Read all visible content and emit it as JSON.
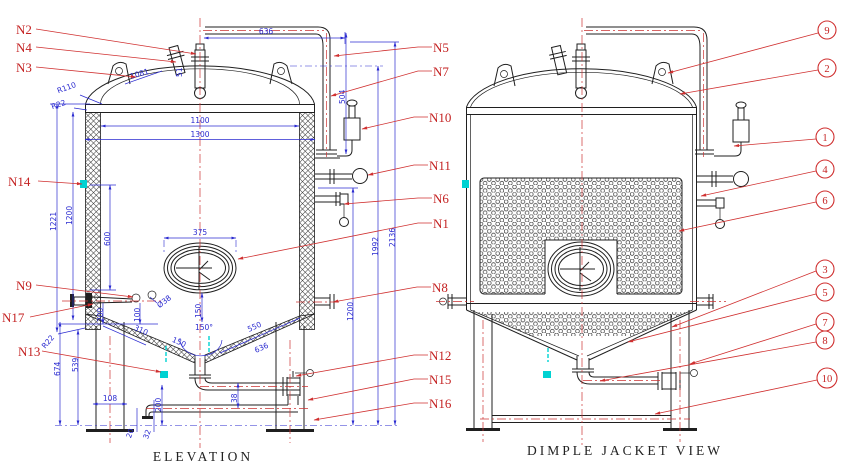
{
  "drawing": {
    "colors": {
      "line": "#1f1f1f",
      "dimension": "#2b2bd0",
      "leader": "#d03030",
      "weld_mark": "#00d2d2"
    },
    "views": {
      "elevation": {
        "title": "ELEVATION",
        "nozzles": [
          "N2",
          "N4",
          "N3",
          "N14",
          "N9",
          "N17",
          "N13",
          "N5",
          "N7",
          "N10",
          "N11",
          "N6",
          "N1",
          "N8",
          "N12",
          "N15",
          "N16"
        ],
        "dims": {
          "d636": "636",
          "d1081": "1081",
          "d51": "51",
          "r110": "R110",
          "r22": "R22",
          "d1100": "1100",
          "d1300": "1300",
          "d1221": "1221",
          "d1200L": "1200",
          "d600": "600",
          "d504": "504",
          "d1200R": "1200",
          "d1992": "1992",
          "d2136": "2136",
          "d375": "375",
          "d150m": "150",
          "dia38": "Ø38",
          "d200a": "200",
          "d100": "100",
          "d310": "310",
          "d150c": "150",
          "a150": "150°",
          "d550": "550",
          "d636c": "636",
          "r22b": "R22",
          "d674": "674",
          "d539": "539",
          "d108": "108",
          "d200b": "200",
          "d38": "38",
          "d20": "20",
          "d32": "32"
        }
      },
      "dimple": {
        "title": "DIMPLE JACKET VIEW",
        "balloons": [
          "9",
          "2",
          "1",
          "4",
          "6",
          "3",
          "5",
          "7",
          "8",
          "10"
        ]
      }
    }
  }
}
